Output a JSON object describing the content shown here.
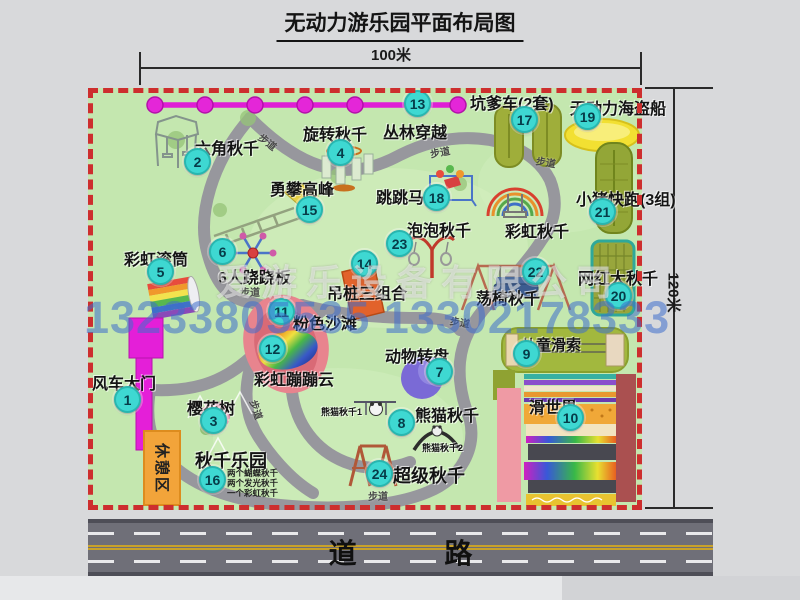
{
  "title": "无动力游乐园平面布局图",
  "dimensions": {
    "width": "100米",
    "height": "120米"
  },
  "road_label": "道 路",
  "path_label": "步道",
  "rest_area_label": "休憩区",
  "watermark": {
    "company": "爱游乐设备有限公司",
    "phone": "13233805535 13302178333"
  },
  "colors": {
    "map_green": "#c4e7af",
    "boundary_red": "#cd2e2e",
    "badge_cyan": "#3ed8d2",
    "chain_magenta": "#df1fd5",
    "gate_magenta": "#e41fd8",
    "rest_orange": "#f2a43a",
    "road_gray": "#6f6f78"
  },
  "attractions": [
    {
      "num": "1",
      "label": "风车大门"
    },
    {
      "num": "2",
      "label": "六角秋千"
    },
    {
      "num": "3",
      "label": "樱花树"
    },
    {
      "num": "4",
      "label": "旋转秋千"
    },
    {
      "num": "5",
      "label": "彩虹滚筒"
    },
    {
      "num": "6",
      "label": "6人跷跷板"
    },
    {
      "num": "7",
      "label": "动物转盘"
    },
    {
      "num": "8",
      "label": "熊猫秋千"
    },
    {
      "num": "9",
      "label": "儿童滑索"
    },
    {
      "num": "10",
      "label": "滑世界"
    },
    {
      "num": "11",
      "label": "粉色沙滩"
    },
    {
      "num": "12",
      "label": "彩虹蹦蹦云"
    },
    {
      "num": "13",
      "label": "丛林穿越"
    },
    {
      "num": "14",
      "label": "吊桩三组合"
    },
    {
      "num": "15",
      "label": "勇攀高峰"
    },
    {
      "num": "16",
      "label": "秋千乐园"
    },
    {
      "num": "17",
      "label": "坑爹车(2套)"
    },
    {
      "num": "18",
      "label": "跳跳马"
    },
    {
      "num": "19",
      "label": "无动力海盗船"
    },
    {
      "num": "20",
      "label": "网红大秋千"
    },
    {
      "num": "21",
      "label": "小猪快跑(3组)"
    },
    {
      "num": "22",
      "label": "荡椅秋千"
    },
    {
      "num": "23",
      "label": "泡泡秋千"
    },
    {
      "num": "24",
      "label": "超级秋千"
    }
  ],
  "unnumbered": {
    "rainbow_swing": "彩虹秋千"
  },
  "sub_labels": {
    "panda1": "熊猫秋千1",
    "panda2": "熊猫秋千2"
  },
  "swing_park_notes": [
    "两个蝴蝶秋千",
    "两个发光秋千",
    "一个彩虹秋千"
  ]
}
